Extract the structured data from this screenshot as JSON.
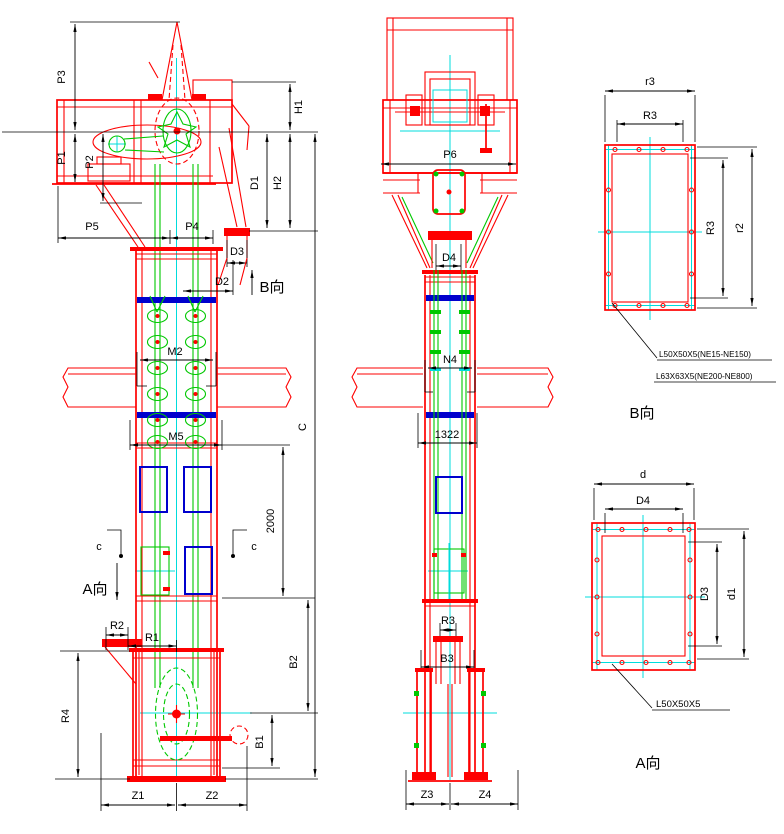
{
  "front": {
    "p3": "P3",
    "p1": "P1",
    "p2": "P2",
    "h1": "H1",
    "h2": "H2",
    "d1": "D1",
    "p5": "P5",
    "p4": "P4",
    "d3": "D3",
    "d2": "D2",
    "view_b": "B向",
    "m2": "M2",
    "m5": "M5",
    "c_total": "C",
    "seg_2000": "2000",
    "sec_c": "c",
    "view_a": "A向",
    "r1": "R1",
    "r2": "R2",
    "r4": "R4",
    "b1": "B1",
    "b2": "B2",
    "z1": "Z1",
    "z2": "Z2"
  },
  "side": {
    "p6": "P6",
    "d4": "D4",
    "n4": "N4",
    "w1322": "1322",
    "r3": "R3",
    "b3": "B3",
    "z3": "Z3",
    "z4": "Z4"
  },
  "section_b": {
    "title": "B向",
    "r3_outer": "r3",
    "r3_top": "R3",
    "r3_side": "R3",
    "r2_side": "r2",
    "note_1": "L50X50X5(NE15-NE150)",
    "note_2": "L63X63X5(NE200-NE800)"
  },
  "section_a": {
    "title": "A向",
    "d_outer": "d",
    "d4_top": "D4",
    "d3_side": "D3",
    "d1_side": "d1",
    "note_1": "L50X50X5"
  },
  "colors": {
    "casing": "#fe0000",
    "mechanism": "#00c800",
    "centerline": "#00dcdc",
    "inspection_panel": "#0000cd",
    "dimension": "#000000",
    "background": "#ffffff"
  }
}
